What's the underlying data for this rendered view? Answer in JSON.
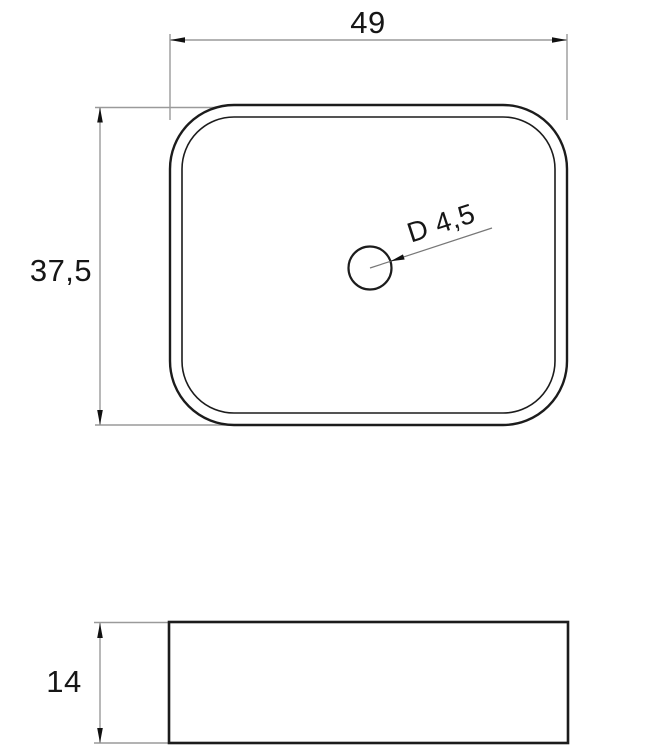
{
  "figure": {
    "type": "technical-drawing",
    "views": {
      "top": {
        "width_label": "49",
        "height_label": "37,5",
        "drain_label": "D 4,5"
      },
      "side": {
        "height_label": "14"
      }
    },
    "values": {
      "width": 49,
      "height": 37.5,
      "drain_diameter": 4.5,
      "side_height": 14
    },
    "colors": {
      "outline": "#1c1c1c",
      "dimension_line": "#9a9a9a",
      "leader_line": "#777777",
      "arrow": "#111111",
      "text": "#161616",
      "background": "#ffffff"
    }
  }
}
